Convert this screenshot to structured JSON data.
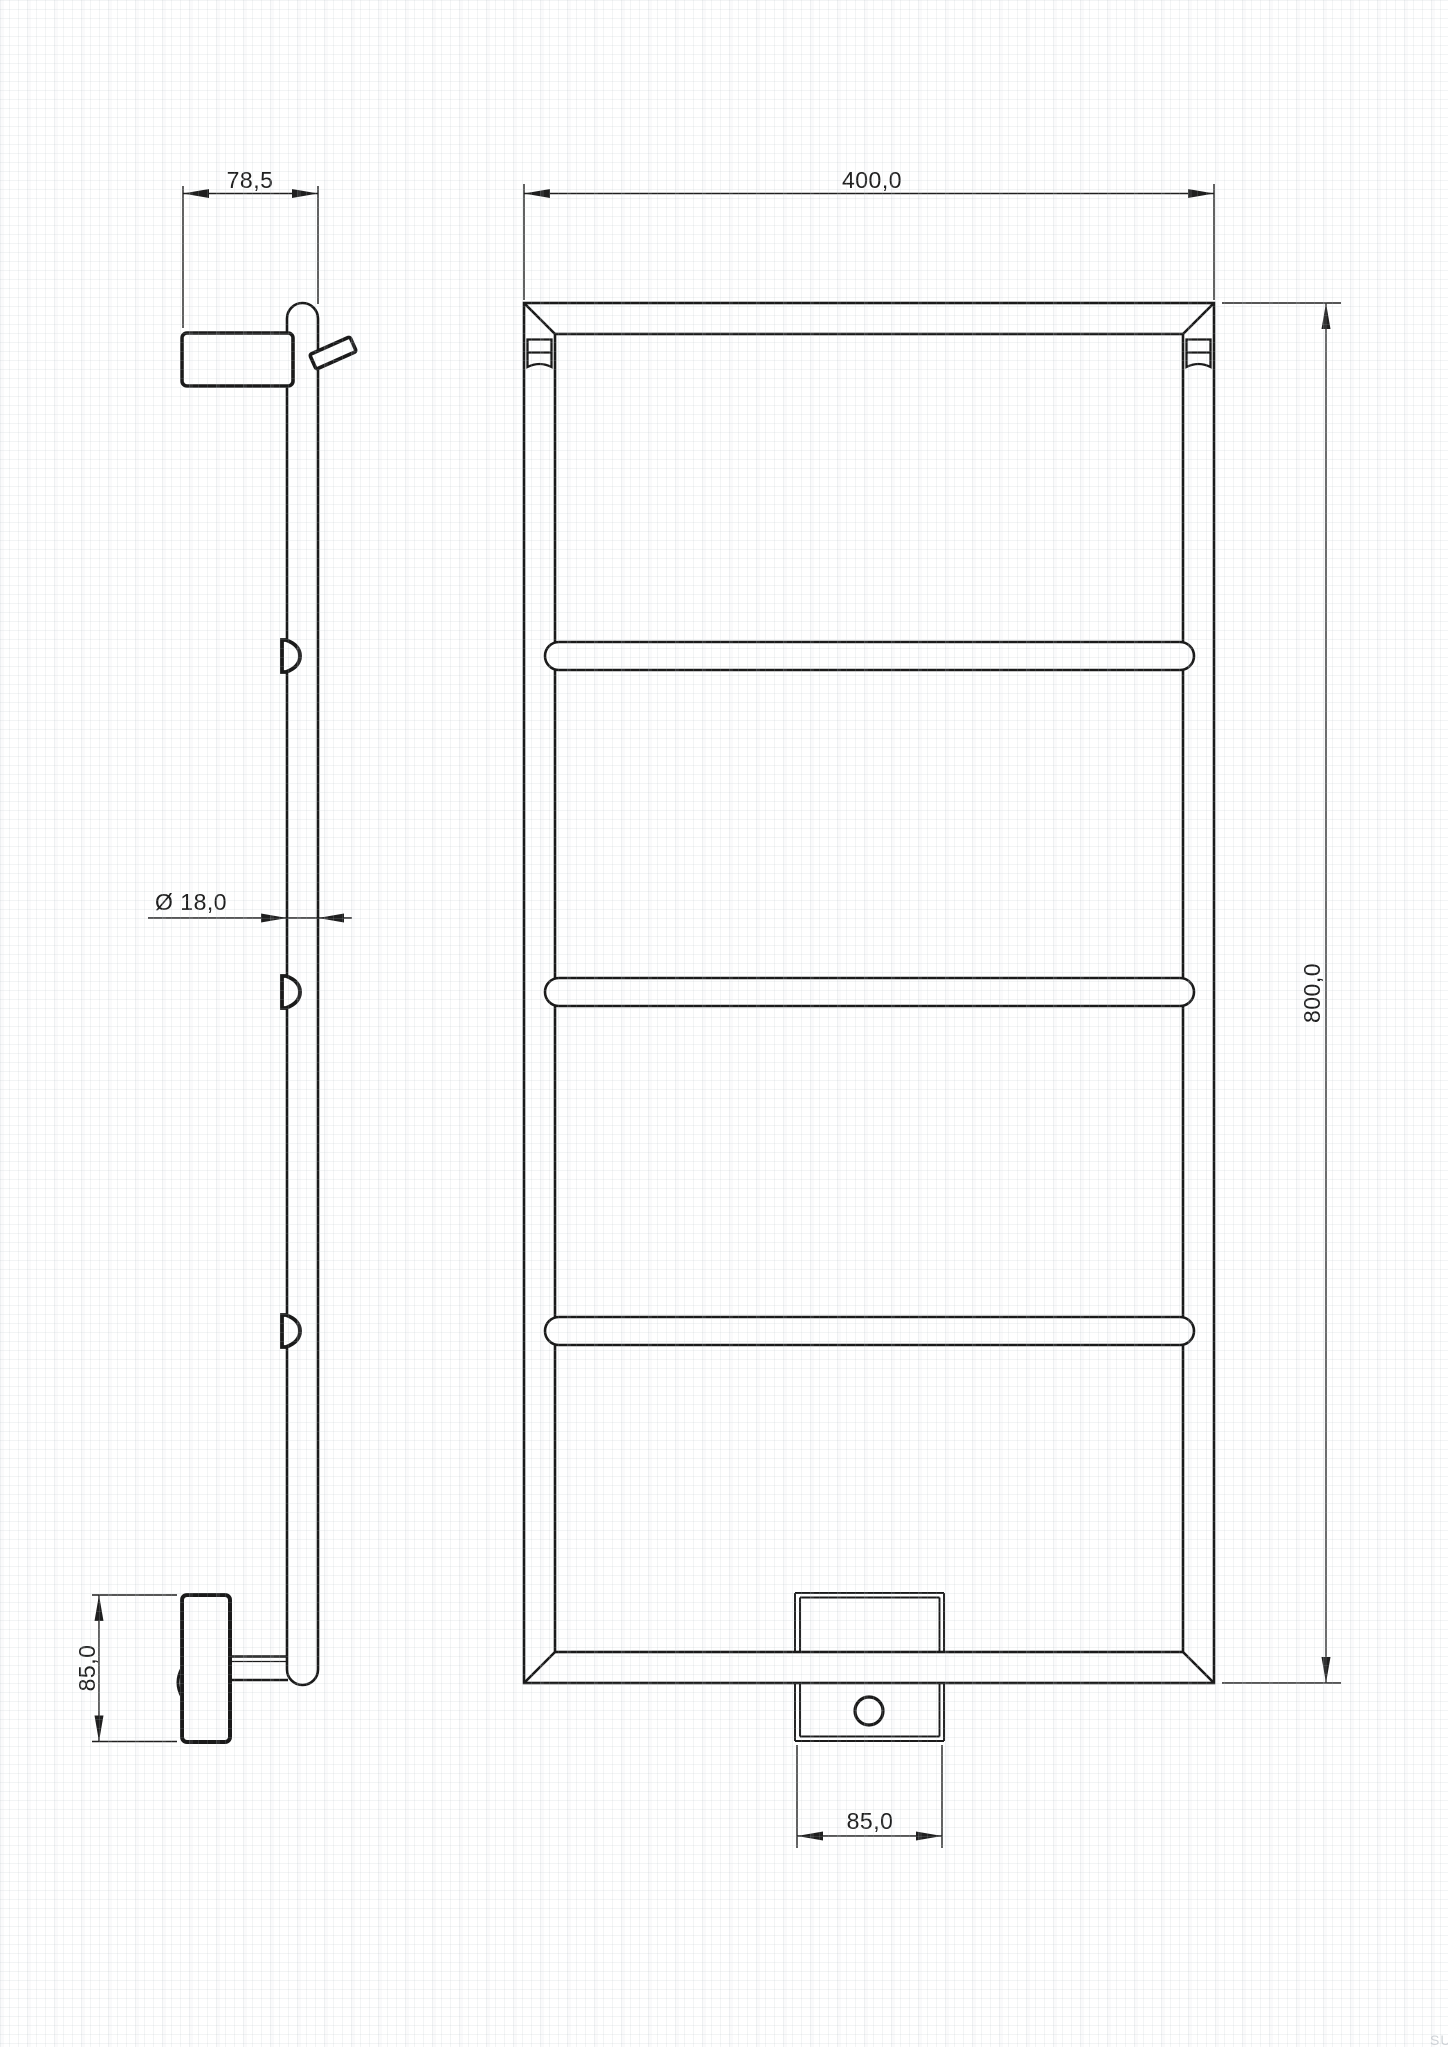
{
  "drawing": {
    "dimensions": {
      "bracket_depth": "78,5",
      "frame_width": "400,0",
      "frame_height": "800,0",
      "tube_diameter": "Ø 18,0",
      "side_bracket_height": "85,0",
      "heater_bracket_width": "85,0"
    },
    "watermark": "SU",
    "colors": {
      "line": "#1a1a1a",
      "dimension": "#1f1f1f",
      "grid": "#dfe3e6",
      "watermark": "#d0d4d8",
      "background": "#ffffff"
    }
  }
}
